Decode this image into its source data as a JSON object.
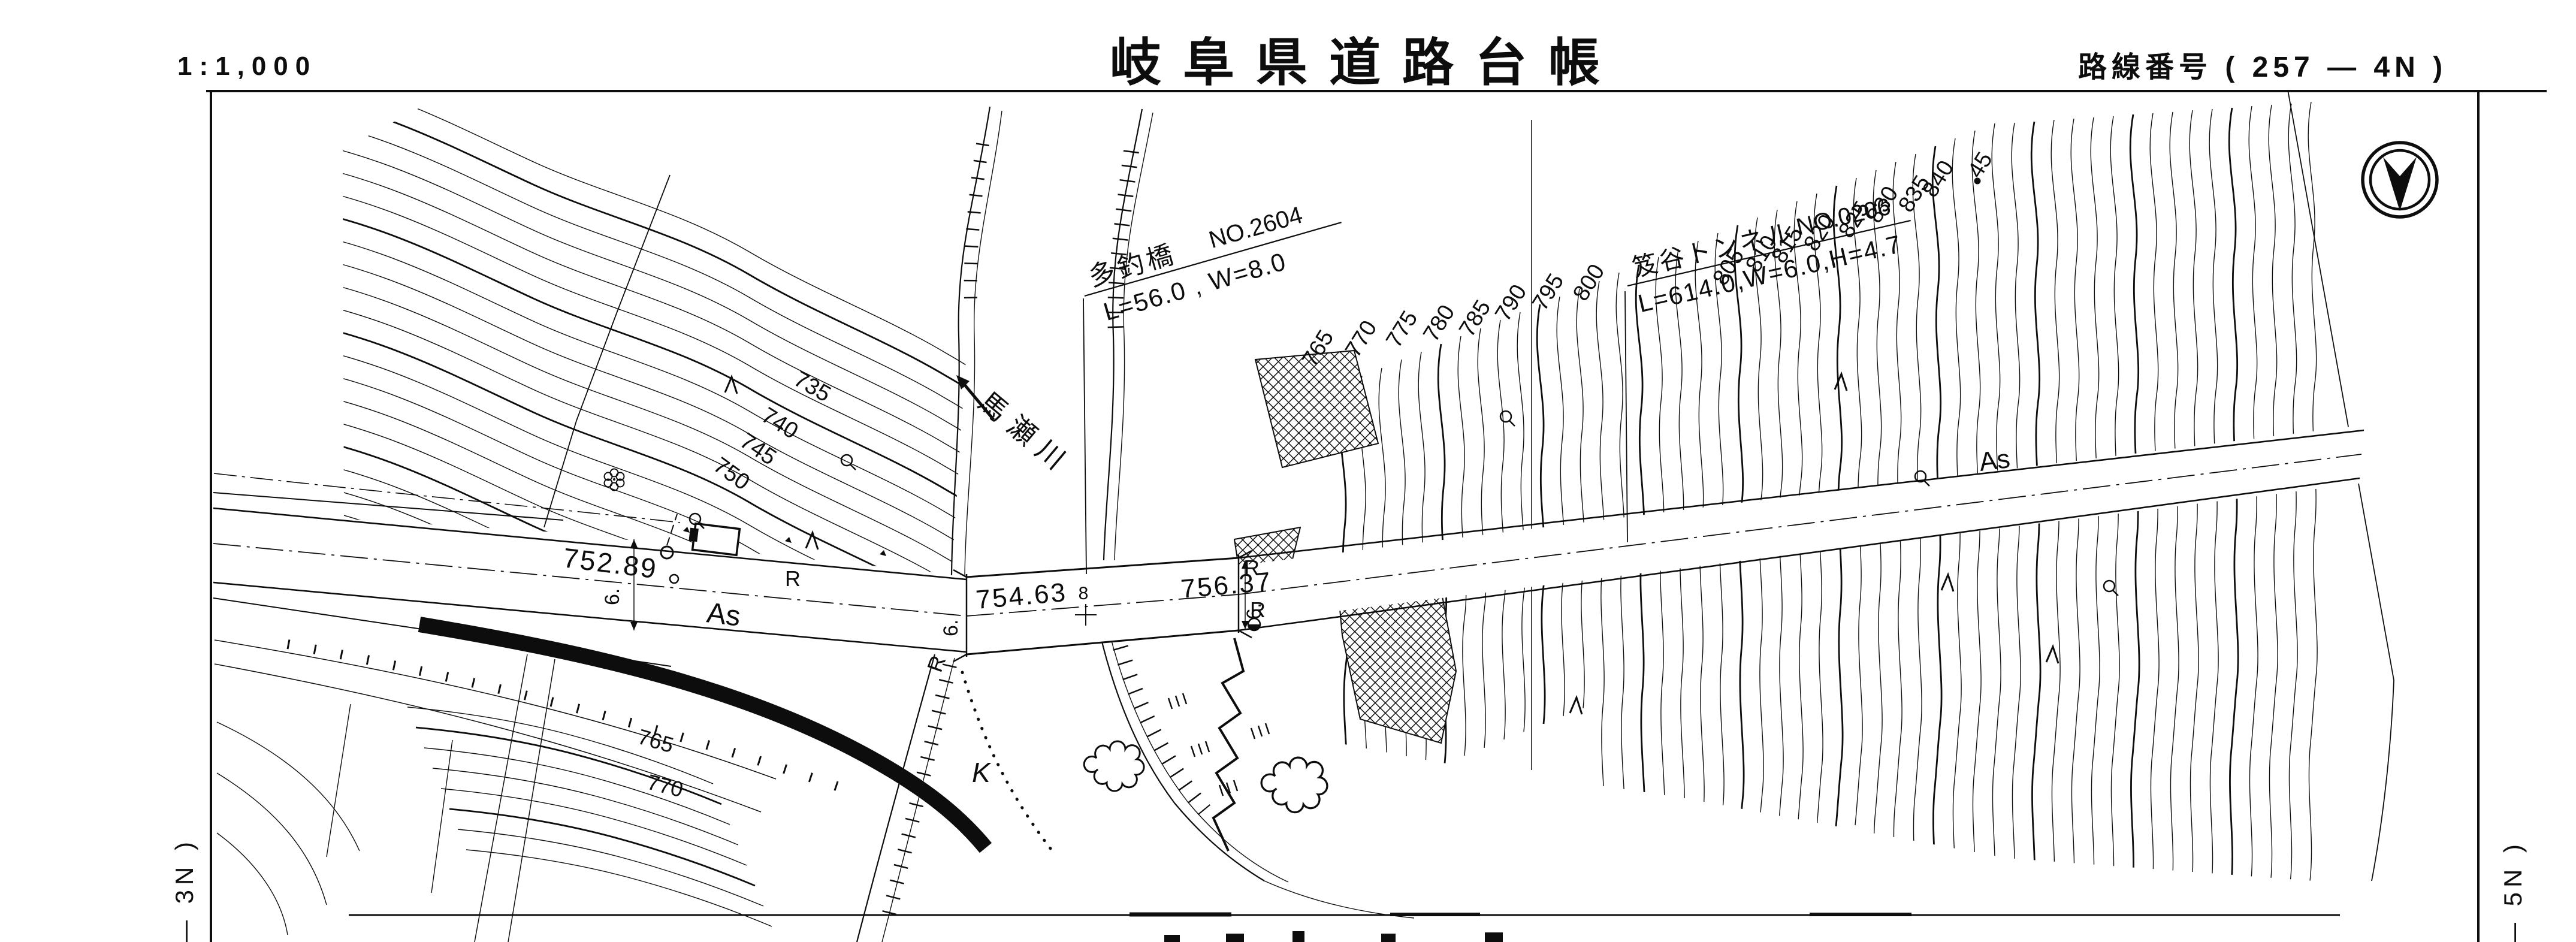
{
  "header": {
    "scale": "1:1,000",
    "title": "岐阜県道路台帳",
    "route": "路線番号 ( 257 — 4N )"
  },
  "margin_labels": {
    "left": "— 3N )",
    "right": "— 5N )"
  },
  "annotations": {
    "bridge": {
      "name": "多釣橋",
      "number": "NO.2604",
      "dims": "L=56.0 , W=8.0"
    },
    "tunnel": {
      "name": "笈谷トンネル",
      "number": "NO.0206",
      "dims": "L=614.0,W=6.0,H=4.7"
    },
    "river": "馬瀬川",
    "elevations": [
      "752.89",
      "754.63",
      "756.37"
    ],
    "station": "8",
    "surface": [
      "As",
      "As"
    ],
    "width_mark": "6.",
    "letter_r": "R",
    "letter_k": "K"
  },
  "contours": {
    "left": [
      "735",
      "740",
      "745",
      "750"
    ],
    "lower_left": [
      "765",
      "770"
    ],
    "right": [
      "765",
      "770",
      "775",
      "780",
      "785",
      "790",
      "795",
      "800",
      "805",
      "810",
      "815",
      "820",
      "825",
      "830",
      "835",
      "840",
      "45"
    ]
  },
  "colors": {
    "ink": "#0d0d0d",
    "paper": "#ffffff"
  }
}
